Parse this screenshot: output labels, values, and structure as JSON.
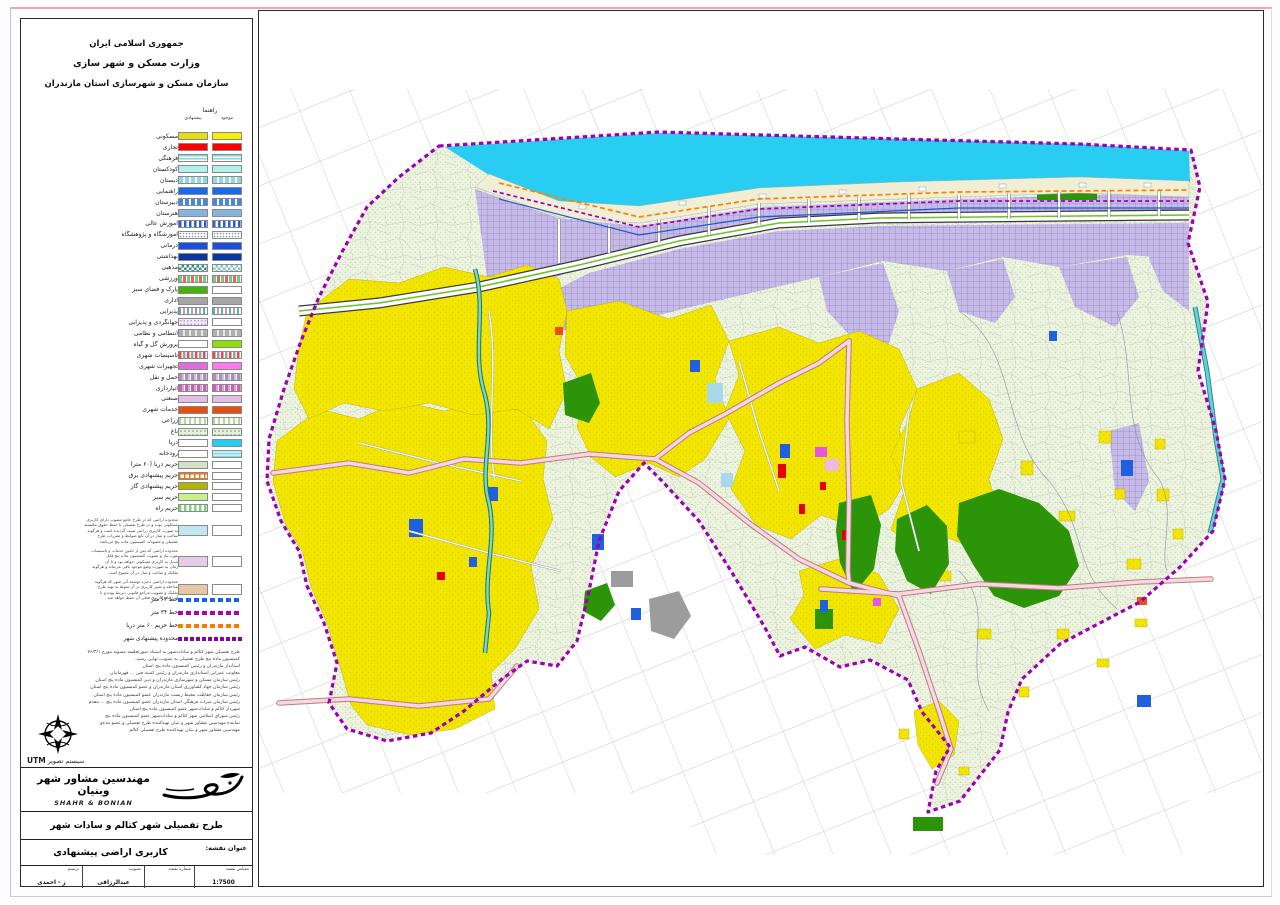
{
  "header": {
    "line1": "جمهوری اسلامی ایران",
    "line2": "وزارت مسکن و شهر سازی",
    "line3": "سازمان مسکن و شهرسازی استان مازندران"
  },
  "legend": {
    "title": "راهنما",
    "col_existing": "موجود",
    "col_proposed": "پیشنهادی",
    "items": [
      {
        "label": "مسکونی",
        "pr": "yellowDull",
        "ex": "yellow"
      },
      {
        "label": "تجاری",
        "pr": "red",
        "ex": "red"
      },
      {
        "label": "فرهنگی",
        "pr": "cyanStripesH",
        "ex": "cyanStripesH"
      },
      {
        "label": "کودکستان",
        "pr": "paleCyan",
        "ex": "paleCyan"
      },
      {
        "label": "دبستان",
        "pr": "cyanBars",
        "ex": "cyanBars"
      },
      {
        "label": "راهنمایی",
        "pr": "blue",
        "ex": "blue"
      },
      {
        "label": "دبیرستان",
        "pr": "blueBars",
        "ex": "blueBars"
      },
      {
        "label": "هنرستان",
        "pr": "steelBlue",
        "ex": "steelBlue"
      },
      {
        "label": "آموزش عالی",
        "pr": "blueBarsWhite",
        "ex": "blueBarsWhite"
      },
      {
        "label": "آموزشگاه و پژوهشگاه",
        "pr": "dotsGray",
        "ex": "dotsGray"
      },
      {
        "label": "درمانی",
        "pr": "blue2",
        "ex": "blue2"
      },
      {
        "label": "بهداشتی",
        "pr": "navy",
        "ex": "navy"
      },
      {
        "label": "مذهبی",
        "pr": "checkTeal",
        "ex": "checkTealLight"
      },
      {
        "label": "ورزشی",
        "pr": "grStripes",
        "ex": "grStripes"
      },
      {
        "label": "پارک و فضای سبز",
        "pr": "green",
        "ex": "white"
      },
      {
        "label": "اداری",
        "pr": "gray",
        "ex": "gray"
      },
      {
        "label": "پذیرایی",
        "pr": "tealPinkBars",
        "ex": "tealPinkBars"
      },
      {
        "label": "جهانگردی و پذیرایی",
        "pr": "lavDots",
        "ex": "white"
      },
      {
        "label": "انتظامی و نظامی",
        "pr": "grayBars",
        "ex": "grayBars"
      },
      {
        "label": "پرورش گل و گیاه",
        "pr": "white",
        "ex": "chartreuse"
      },
      {
        "label": "تاسیسات شهری",
        "pr": "redGrayBars",
        "ex": "redGrayBars"
      },
      {
        "label": "تجهیزات شهری",
        "pr": "magenta",
        "ex": "magenta2"
      },
      {
        "label": "حمل و نقل",
        "pr": "purpGrayBars",
        "ex": "purpGrayBars"
      },
      {
        "label": "انبارداری",
        "pr": "magGrayBars",
        "ex": "magGrayBars"
      },
      {
        "label": "صنعتی",
        "pr": "plum",
        "ex": "plum"
      },
      {
        "label": "خدمات شهری",
        "pr": "orangeRed",
        "ex": "orangeRed"
      },
      {
        "label": "زراعی",
        "pr": "greenBars",
        "ex": "greenBars"
      },
      {
        "label": "باغ",
        "pr": "greenDots",
        "ex": "greenDots"
      },
      {
        "label": "دریا",
        "pr": "white",
        "ex": "cyan"
      },
      {
        "label": "رودخانه",
        "pr": "white",
        "ex": "cyanWave"
      },
      {
        "label": "حریم دریا (۶۰ متر)",
        "pr": "sage",
        "ex": "white"
      },
      {
        "label": "حریم پیشنهادی برق",
        "pr": "orangeGrid",
        "ex": "white"
      },
      {
        "label": "حریم پیشنهادی گاز",
        "pr": "olive",
        "ex": "white"
      },
      {
        "label": "حریم سبز",
        "pr": "limePale",
        "ex": "white"
      },
      {
        "label": "حریم راه",
        "pr": "greenBars2",
        "ex": "white"
      }
    ],
    "notes": [
      {
        "swatch": "#c2e6ee",
        "lines": [
          "محدوده اراضی که در طرح جامع مصوب دارای کاربری",
          "مسکونی بوده و در طرح تفصیلی با حفظ حقوق مکتسبه",
          "به صورت کاربری زراعی تثبیت گردیده است و هرگونه",
          "ساخت و ساز در آن تابع ضوابط و مقررات طرح",
          "تفصیلی و مصوبات کمیسیون ماده پنج می‌باشد"
        ]
      },
      {
        "swatch": "#e6cce6",
        "lines": [
          "محدوده اراضی که پس از تامین خدمات و تاسیسات",
          "مورد نیاز و تصویب کمیسیون ماده پنج قابل",
          "تبدیل به کاربری مسکونی خواهد بود و تا آن",
          "زمان به صورت وضع موجود باقی می‌ماند و هرگونه",
          "تفکیک و ساخت و ساز در آن ممنوع است"
        ]
      },
      {
        "swatch": "#e6c8a4",
        "lines": [
          "محدوده اراضی ذخیره توسعه آتی شهر که هرگونه",
          "مداخله و تغییر کاربری در آن منوط به تهیه طرح",
          "تفکیک و تصویب مراجع قانونی ذیربط بوده و تا",
          "آن زمان کاربری فعلی آن حفظ خواهد شد"
        ]
      }
    ],
    "line_keys": [
      {
        "label": "خط ۶۳ متر",
        "style": "dashBlue"
      },
      {
        "label": "خط ۳۴ متر",
        "style": "dashPurple"
      },
      {
        "label": "خط حریم ۶۰ متر دریا",
        "style": "dashOrange"
      },
      {
        "label": "محدوده پیشنهادی شهر",
        "style": "dashBoundary"
      }
    ]
  },
  "swatch_styles": {
    "yellow": "#f7ee00",
    "yellowDull": "#e8dc10",
    "red": "#fe0000",
    "cyanStripesH": "repeating-linear-gradient(180deg,#7fd8d4 0 1.5px,#ffffff 1.5px 3px)",
    "paleCyan": "#b2f0ec",
    "cyanBars": "repeating-linear-gradient(90deg,#8fd8e4 0 4px,#ffffff 4px 6px)",
    "blue": "#1d6ae8",
    "blueBars": "repeating-linear-gradient(90deg,#4488e0 0 4px,#ffffff 4px 6px)",
    "steelBlue": "#86b4e0",
    "blueBarsWhite": "repeating-linear-gradient(90deg,#2b5cd8 0 2.5px,#ffffff 2.5px 5px)",
    "dotsGray": "radial-gradient(circle,#8899aa 0.7px,transparent 0.9px) 0 0/3px 3px repeat #ffffff",
    "blue2": "#1850e0",
    "navy": "#0c36a0",
    "checkTeal": "repeating-conic-gradient(#2e9288 0% 25%, #ffffff 0% 50%) 0 0/5px 5px",
    "checkTealLight": "repeating-conic-gradient(#7ec8c0 0% 25%, #ffffff 0% 50%) 0 0/5px 5px",
    "grStripes": "repeating-linear-gradient(90deg,#7cc87c 0 3px,#ffffff 3px 4px,#e06868 4px 7px,#ffffff 7px 8px)",
    "green": "#42b40a",
    "white": "#ffffff",
    "gray": "#a6a6a6",
    "tealPinkBars": "repeating-linear-gradient(90deg,#4fb8ac 0 2px,#ffffff 2px 4px,#e888b8 4px 6px,#ffffff 6px 8px)",
    "lavDots": "radial-gradient(circle,#b49ae0 0.8px,transparent 1px) 0 0/3.5px 3.5px repeat #f2ecfa",
    "grayBars": "repeating-linear-gradient(90deg,#b0b0b0 0 4px,#e8e8e8 4px 6px)",
    "chartreuse": "#8ce000",
    "redGrayBars": "repeating-linear-gradient(90deg,#e05050 0 2.5px,#ffffff 2.5px 4px,#a0a0a0 4px 6.5px,#ffffff 6.5px 8px)",
    "magenta": "#e06ae0",
    "magenta2": "#ff78f0",
    "purpGrayBars": "repeating-linear-gradient(90deg,#b088c8 0 3px,#c8c8c8 3px 5px,#ffffff 5px 6px)",
    "magGrayBars": "repeating-linear-gradient(90deg,#e050c8 0 3px,#b8b8b8 3px 5px,#ffffff 5px 6px)",
    "plum": "#e2bce8",
    "orangeRed": "#e84e12",
    "greenBars": "repeating-linear-gradient(90deg,#a8e098 0 2px,#ffffff 2px 5px)",
    "greenDots": "radial-gradient(circle,#90c090 0.8px,transparent 1px) 0 0/4px 4px repeat #e4f2dc",
    "cyan": "#28ccf0",
    "cyanWave": "repeating-linear-gradient(180deg,#bfeef5 0 2px,#7fd8ec 2px 3px)",
    "sage": "#d6e2c6",
    "orangeGrid": "repeating-linear-gradient(90deg,#e87818 0 1.5px,transparent 1.5px 5px),repeating-linear-gradient(180deg,#e87818 0 1.5px,#ffffff 1.5px 5px)",
    "olive": "#b4b400",
    "limePale": "#c8f08c",
    "greenBars2": "repeating-linear-gradient(90deg,#80d080 0 2.5px,#ffffff 2.5px 5px)",
    "dashBlue": "repeating-linear-gradient(90deg,#1560e8 0 5px,transparent 5px 8px)",
    "dashPurple": "repeating-linear-gradient(90deg,#b000b0 0 5px,transparent 5px 8px)",
    "dashOrange": "repeating-linear-gradient(90deg,#ff7800 0 5px,transparent 5px 8px)",
    "dashBoundary": "repeating-linear-gradient(90deg,#8800aa 0 4px,transparent 4px 6px)"
  },
  "approval_notes": [
    "طرح تفصیلی شهر کتالم و سادات‌شهر به استناد صورتجلسه مصوبه مورخ ۷۶/۳/۱",
    "کمیسیون ماده پنج طرح تفصیلی به تصویب نهایی رسید.",
    "استاندار مازندران و رئیس کمیسیون ماده پنج استان",
    "معاونت عمرانی استانداری مازندران و رئیس کمیته فنی ... قهرمانیان",
    "رئیس سازمان مسکن و شهرسازی مازندران و دبیر کمیسیون ماده پنج استان",
    "رئیس سازمان جهاد کشاورزی استان مازندران و عضو کمیسیون ماده پنج استان",
    "رئیس سازمان حفاظت محیط زیست مازندران عضو کمیسیون ماده پنج استان",
    "رئیس سازمان میراث فرهنگی استان مازندران عضو کمیسیون ماده پنج ... مقدم",
    "شهردار کتالم و سادات‌شهر عضو کمیسیون ماده پنج استان",
    "رئیس شورای اسلامی شهر کتالم و سادات‌شهر عضو کمیسیون ماده پنج",
    "نماینده مهندسین مشاور شهر و بنیان تهیه‌کننده طرح تفصیلی و عضو مدعو",
    "مهندسین مشاور شهر و بنیان تهیه‌کننده طرح تفصیلی کتالم"
  ],
  "projection": {
    "label": "سیستم تصویر",
    "value": "UTM"
  },
  "firm": {
    "name_fa": "مهندسین مشاور شهر وبنیان",
    "name_en": "SHAHR & BONIAN"
  },
  "project_title": "طرح تفصیلی شهر کتالم و سادات شهر",
  "map_title": {
    "label": "عنوان نقشه:",
    "value": "کاربری اراضی پیشنهادی"
  },
  "title_block": {
    "cells": [
      {
        "label": "مقیاس نقشه",
        "value": "1:7500"
      },
      {
        "label": "شماره نقشه",
        "value": ""
      },
      {
        "label": "تصویب",
        "value": "عبدالرزاقی"
      },
      {
        "label": "ترسیم",
        "value": "ز - احمدی"
      }
    ]
  },
  "map": {
    "colors": {
      "sea": "#29cdf2",
      "land": "#ecf3de",
      "landdot": "#b7c9a2",
      "yellow": "#f2e600",
      "lavender": "#c6bae6",
      "lavline": "#9488cc",
      "park": "#2b9408",
      "roadpink": "#f4d9de",
      "roadcase": "#c0788a",
      "boundary": "#9b00b4",
      "river": "#7fd6c8",
      "rivercase": "#1f7a5e",
      "beach": "#f1eed6",
      "hwgreen": "#6cc428",
      "grid": "#c9c9c9",
      "orange_line": "#ff7f00",
      "blue_line": "#2058c8"
    }
  }
}
